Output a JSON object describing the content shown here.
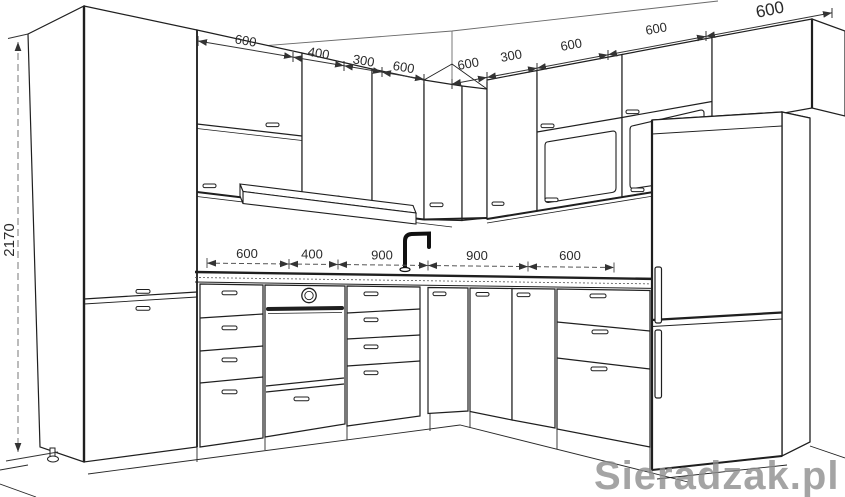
{
  "meta": {
    "title": "Kitchen corner layout - 3D technical line drawing",
    "watermark": "Sieradzak.pl"
  },
  "colors": {
    "line": "#1f1f1f",
    "dim_text": "#2b2b2b",
    "watermark": "#8e8e8e",
    "background": "#ffffff"
  },
  "dimensions": {
    "height_mm": "2170",
    "upper_left_run": [
      "600",
      "400",
      "300",
      "600"
    ],
    "upper_right_run": [
      "600",
      "300",
      "600",
      "600",
      "600"
    ],
    "counter_run": [
      "600",
      "400",
      "900",
      "900",
      "600"
    ]
  }
}
